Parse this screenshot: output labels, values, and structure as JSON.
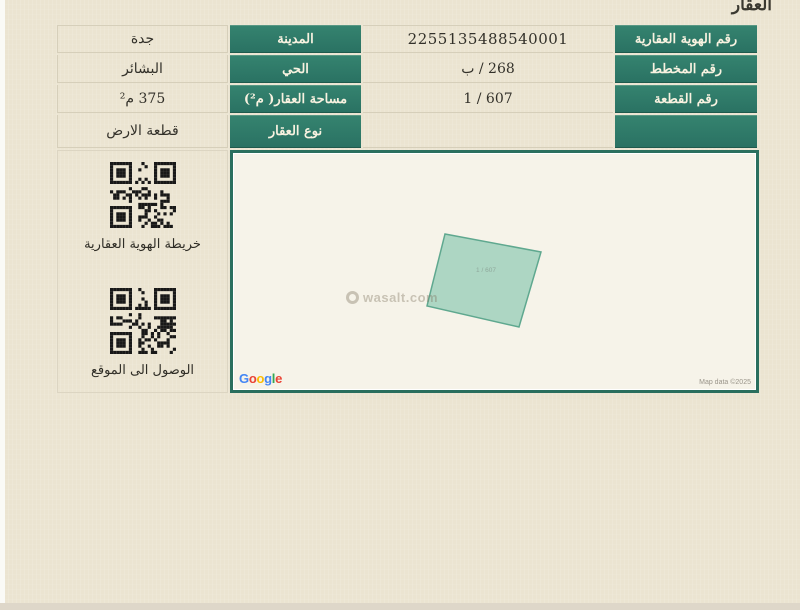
{
  "page": {
    "title": "العقار",
    "colors": {
      "background": "#ebe4d1",
      "header_green": "#2d7a69",
      "map_border": "#2a6f5e",
      "parcel_fill": "#a9d4c1",
      "parcel_stroke": "#5fa88f",
      "qr_black": "#181818"
    }
  },
  "property_table": {
    "right_rows": [
      {
        "label": "رقم الهوية العقارية",
        "value": "2255135488540001"
      },
      {
        "label": "رقم المخطط",
        "value": "268 / ب"
      },
      {
        "label": "رقم القطعة",
        "value": "607 / 1"
      },
      {
        "label": "",
        "value": ""
      }
    ],
    "left_rows": [
      {
        "label": "المدينة",
        "value": "جدة"
      },
      {
        "label": "الحي",
        "value": "البشائر"
      },
      {
        "label": "مساحة العقار( م²)",
        "value": "375 م²"
      },
      {
        "label": "نوع العقار",
        "value": "قطعة الارض"
      }
    ]
  },
  "qr_links": [
    {
      "label": "خريطة الهوية العقارية"
    },
    {
      "label": "الوصول الى الموقع"
    }
  ],
  "map": {
    "parcel_label": "607 / 1",
    "watermark": "wasalt.com",
    "google": "Google",
    "google_colors": [
      "#4285F4",
      "#EA4335",
      "#FBBC05",
      "#4285F4",
      "#34A853",
      "#EA4335"
    ],
    "attribution": "Map data ©2025"
  }
}
